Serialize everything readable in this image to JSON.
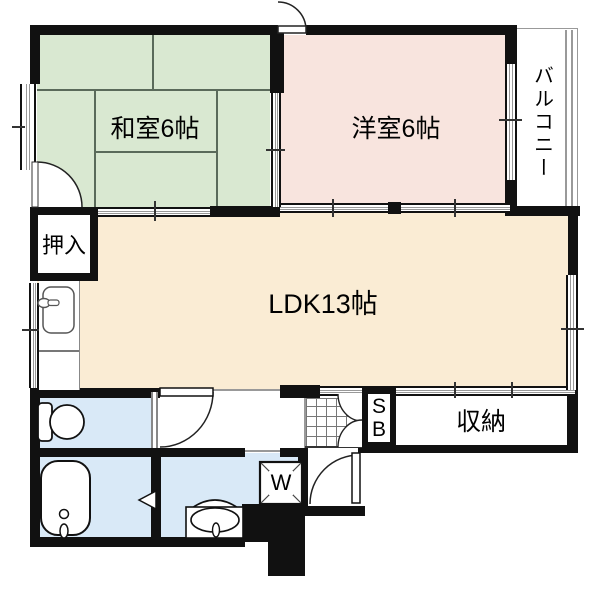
{
  "floorplan": {
    "rooms": {
      "washitsu": "和室6帖",
      "yoshitsu": "洋室6帖",
      "ldk": "LDK13帖",
      "oshiire": "押入",
      "balcony": "バルコニー",
      "storage": "収納",
      "shoebox_s": "S",
      "shoebox_b": "B",
      "washer": "W"
    },
    "colors": {
      "tatami_room": "#d9e8d1",
      "western_room": "#f8e4de",
      "ldk": "#faecd4",
      "wet_rooms": "#d9e9f7",
      "wall": "#111111"
    }
  }
}
